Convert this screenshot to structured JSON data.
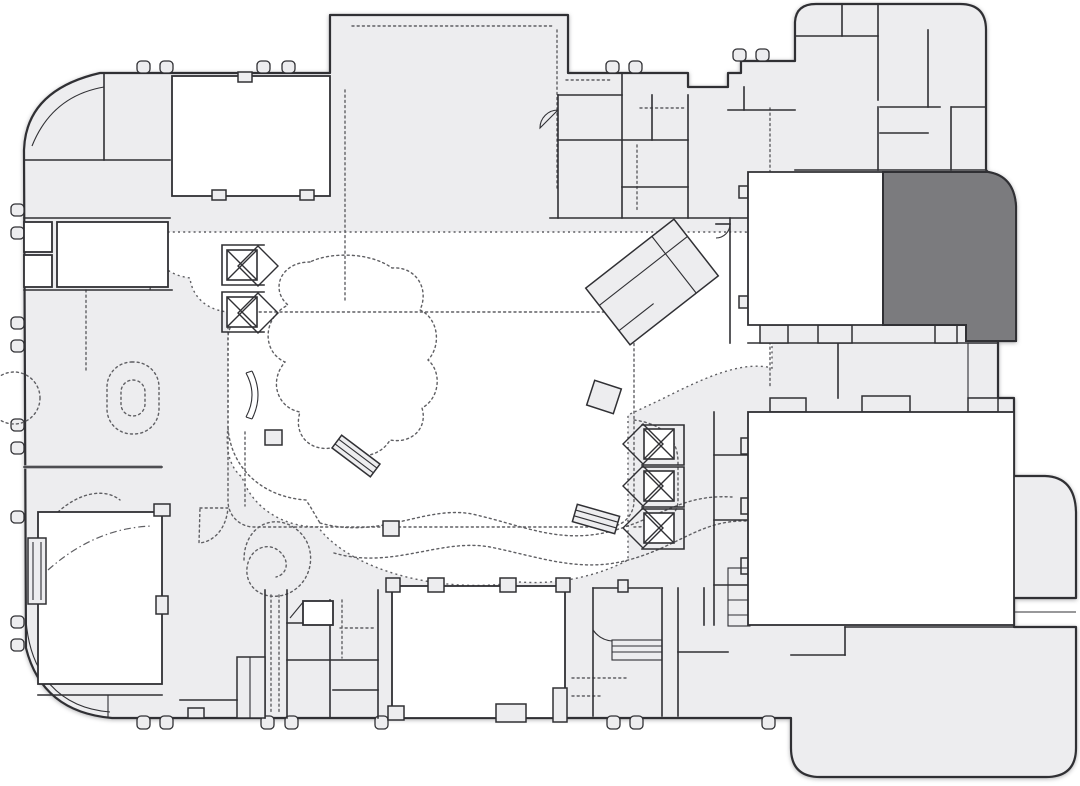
{
  "meta": {
    "type": "architectural-floor-plan",
    "aria_label": "Building floor plan with one highlighted room in the upper right corner",
    "orientation": "plan view",
    "visible_text": "none"
  },
  "palette": {
    "background": "#ffffff",
    "floor": "#ededef",
    "room_fill": "#ffffff",
    "highlight": "#7b7b7e",
    "wall": "#303034",
    "wall_light": "#a8a8ac",
    "dashed_detail": "#5f5f63"
  },
  "features": {
    "highlighted_room": {
      "name": "selected-room",
      "state": "highlighted",
      "location": "upper-right",
      "fill": "#7b7b7e"
    },
    "elevator_banks": [
      {
        "location": "west-atrium",
        "cars": 2,
        "symbol": "square-with-x-and-diamond"
      },
      {
        "location": "east-atrium",
        "cars": 3,
        "symbol": "square-with-x-and-diamond"
      }
    ],
    "major_rooms": [
      {
        "name": "northwest-hall",
        "fill": "white"
      },
      {
        "name": "north-pavilion",
        "fill": "floor-gray",
        "note": "protrudes above main outline"
      },
      {
        "name": "northeast-hall",
        "fill": "white-left-half, highlighted-right-half"
      },
      {
        "name": "east-ballroom",
        "fill": "white"
      },
      {
        "name": "south-ballroom",
        "fill": "white"
      },
      {
        "name": "southwest-theater",
        "fill": "white",
        "note": "stage strip on left wall"
      },
      {
        "name": "northeast-service-block",
        "fill": "floor-gray",
        "note": "rounded top corners"
      },
      {
        "name": "southeast-wing",
        "fill": "floor-gray",
        "note": "rounded bottom corners"
      }
    ],
    "decorations": [
      "atrium-garden-dashed-boundary",
      "dashed-garden-bed-rounded-rectangle",
      "organic-planter-blob",
      "double-wavy-dashed-path",
      "spiral-stair-dashed",
      "stadium-shaped-planter-dashed",
      "dashed-circle-west-edge",
      "angled-grand-stair-structure",
      "escalator-bands",
      "door-swing-arcs",
      "perimeter-door-bumps"
    ]
  }
}
